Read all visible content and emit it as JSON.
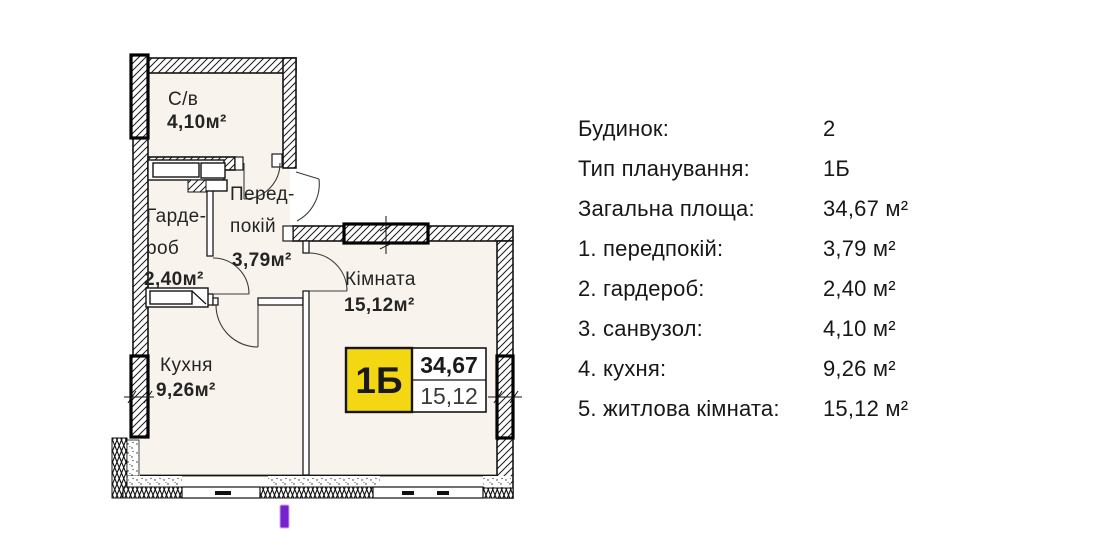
{
  "plan": {
    "rooms": {
      "bathroom": {
        "name": "С/в",
        "area": "4,10м²"
      },
      "wardrobe": {
        "name_line1": "Гарде-",
        "name_line2": "роб",
        "area": "2,40м²"
      },
      "hallway": {
        "name_line1": "Перед-",
        "name_line2": "покій",
        "area": "3,79м²"
      },
      "room": {
        "name": "Кімната",
        "area": "15,12м²"
      },
      "kitchen": {
        "name": "Кухня",
        "area": "9,26м²"
      }
    },
    "badge": {
      "type": "1Б",
      "total_area": "34,67",
      "living_area": "15,12"
    }
  },
  "info": {
    "rows": [
      {
        "label": "Будинок:",
        "value": "2"
      },
      {
        "label": "Тип планування:",
        "value": "1Б"
      },
      {
        "label": "Загальна площа:",
        "value": "34,67 м²"
      },
      {
        "label": "1. передпокій:",
        "value": "3,79 м²"
      },
      {
        "label": "2. гардероб:",
        "value": "2,40 м²"
      },
      {
        "label": "3. санвузол:",
        "value": "4,10 м²"
      },
      {
        "label": "4. кухня:",
        "value": "9,26 м²"
      },
      {
        "label": "5. житлова кімната:",
        "value": "15,12 м²"
      }
    ]
  },
  "colors": {
    "badge_yellow": "#F3D713",
    "marker_purple": "#7722CE",
    "plan_interior": "#F8F4ED"
  }
}
